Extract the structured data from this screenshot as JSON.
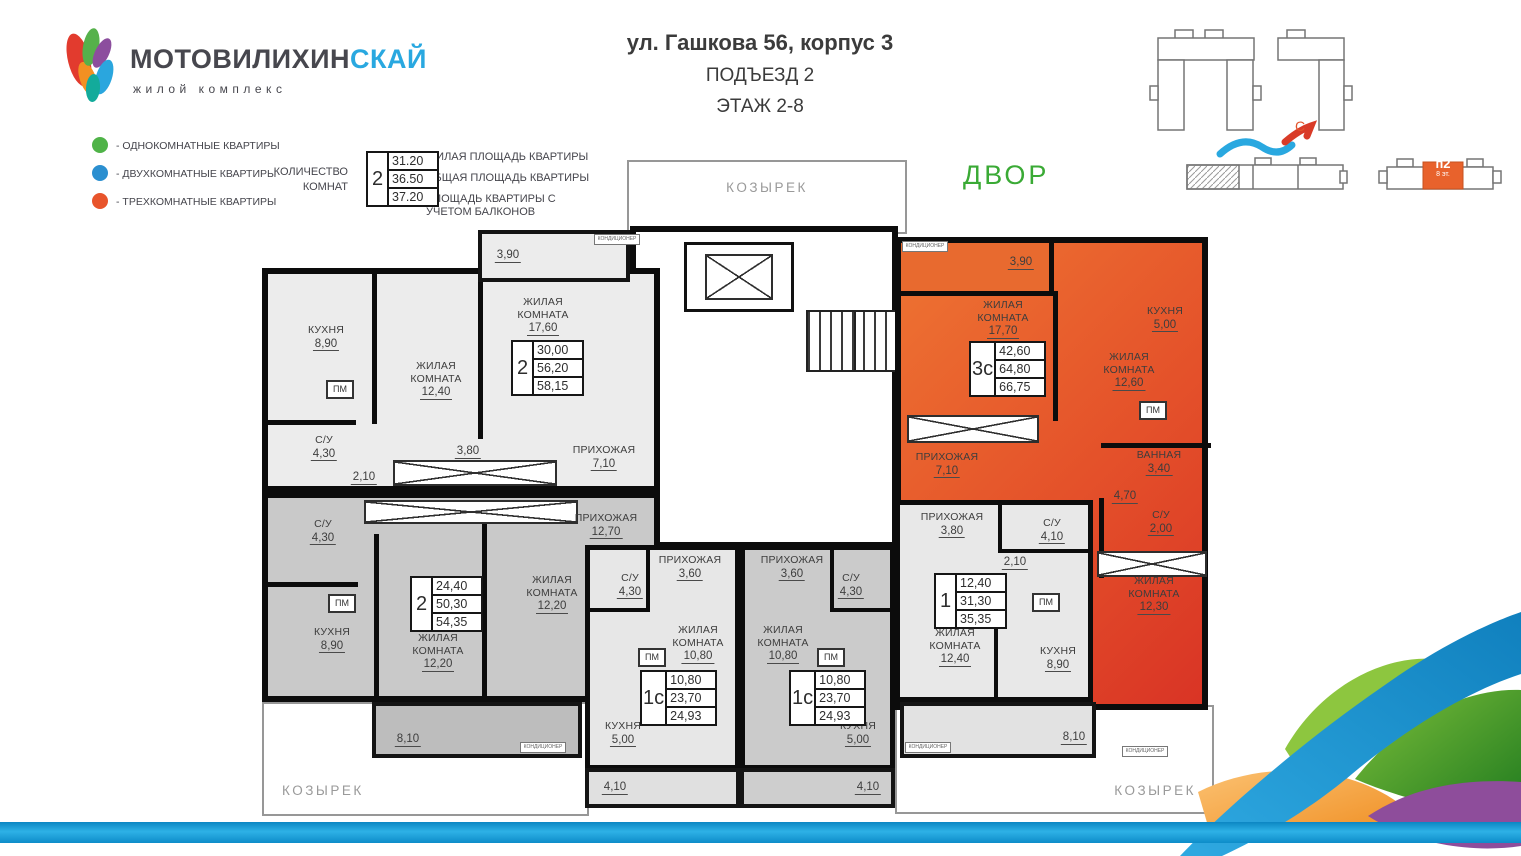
{
  "brand": {
    "name_dark": "МОТОВИЛИХИН",
    "name_accent": "СКАЙ",
    "tagline": "жилой комплекс",
    "accent_color": "#29a8e0"
  },
  "header": {
    "address": "ул. Гашкова 56, корпус 3",
    "entrance": "ПОДЪЕЗД 2",
    "floors": "ЭТАЖ 2-8"
  },
  "legend": {
    "types": [
      {
        "label": "- ОДНОКОМНАТНЫЕ КВАРТИРЫ",
        "color": "#4fb348"
      },
      {
        "label": "- ДВУХКОМНАТНЫЕ КВАРТИРЫ",
        "color": "#2b8fd0"
      },
      {
        "label": "- ТРЕХКОМНАТНЫЕ КВАРТИРЫ",
        "color": "#e8542b"
      }
    ],
    "rooms_count_line1": "КОЛИЧЕСТВО",
    "rooms_count_line2": "КОМНАТ",
    "sample": {
      "rooms": "2",
      "living": "31.20",
      "total": "36.50",
      "total_balcony": "37.20"
    },
    "area_line1": "ЖИЛАЯ ПЛОЩАДЬ КВАРТИРЫ",
    "area_line2": "ОБЩАЯ ПЛОЩАДЬ КВАРТИРЫ",
    "area_line3": "ПЛОЩАДЬ КВАРТИРЫ С УЧЕТОМ БАЛКОНОВ"
  },
  "site": {
    "entrance": "п2",
    "floors": "8 эт.",
    "north": "С",
    "highlight_color": "#e8622c"
  },
  "labels": {
    "courtyard": "ДВОР",
    "canopy": "КОЗЫРЕК",
    "conditioner": "КОНДИЦИОНЕР",
    "pm": "ПМ"
  },
  "apartments": {
    "a": {
      "type": "2",
      "living": "30,00",
      "total": "56,20",
      "total_balcony": "58,15",
      "kitchen_name": "КУХНЯ",
      "kitchen_area": "8,90",
      "room1_name": "ЖИЛАЯ КОМНАТА",
      "room1_area": "12,40",
      "room2_name": "ЖИЛАЯ КОМНАТА",
      "room2_area": "17,60",
      "bath_name": "С/У",
      "bath_area": "4,30",
      "hall_name": "ПРИХОЖАЯ",
      "hall_area": "7,10",
      "corridor_area": "2,10",
      "hall2_area": "3,80",
      "balcony_area": "3,90"
    },
    "b": {
      "type": "3с",
      "living": "42,60",
      "total": "64,80",
      "total_balcony": "66,75",
      "room1_name": "ЖИЛАЯ КОМНАТА",
      "room1_area": "17,70",
      "kitchen_name": "КУХНЯ",
      "kitchen_area": "5,00",
      "room2_name": "ЖИЛАЯ КОМНАТА",
      "room2_area": "12,60",
      "hall_name": "ПРИХОЖАЯ",
      "hall_area": "7,10",
      "bath_name": "ВАННАЯ",
      "bath_area": "3,40",
      "wc_name": "С/У",
      "wc_area": "2,00",
      "corridor_area": "4,70",
      "room3_name": "ЖИЛАЯ КОМНАТА",
      "room3_area": "12,30",
      "balcony_area": "3,90"
    },
    "c": {
      "type": "2",
      "living": "24,40",
      "total": "50,30",
      "total_balcony": "54,35",
      "bath_name": "С/У",
      "bath_area": "4,30",
      "kitchen_name": "КУХНЯ",
      "kitchen_area": "8,90",
      "room1_name": "ЖИЛАЯ КОМНАТА",
      "room1_area": "12,20",
      "room2_name": "ЖИЛАЯ КОМНАТА",
      "room2_area": "12,20",
      "hall_name": "ПРИХОЖАЯ",
      "hall_area": "12,70",
      "balcony_area": "8,10"
    },
    "d": {
      "type": "1с",
      "living": "10,80",
      "total": "23,70",
      "total_balcony": "24,93",
      "hall_name": "ПРИХОЖАЯ",
      "hall_area": "3,60",
      "bath_name": "С/У",
      "bath_area": "4,30",
      "room_name": "ЖИЛАЯ КОМНАТА",
      "room_area": "10,80",
      "kitchen_name": "КУХНЯ",
      "kitchen_area": "5,00",
      "balcony_area": "4,10"
    },
    "e": {
      "type": "1с",
      "living": "10,80",
      "total": "23,70",
      "total_balcony": "24,93",
      "hall_name": "ПРИХОЖАЯ",
      "hall_area": "3,60",
      "bath_name": "С/У",
      "bath_area": "4,30",
      "room_name": "ЖИЛАЯ КОМНАТА",
      "room_area": "10,80",
      "kitchen_name": "КУХНЯ",
      "kitchen_area": "5,00",
      "balcony_area": "4,10"
    },
    "f": {
      "type": "1",
      "living": "12,40",
      "total": "31,30",
      "total_balcony": "35,35",
      "hall_name": "ПРИХОЖАЯ",
      "hall_area": "3,80",
      "bath_name": "С/У",
      "bath_area": "4,10",
      "corridor_area": "2,10",
      "room_name": "ЖИЛАЯ КОМНАТА",
      "room_area": "12,40",
      "kitchen_name": "КУХНЯ",
      "kitchen_area": "8,90",
      "balcony_area": "8,10"
    }
  }
}
